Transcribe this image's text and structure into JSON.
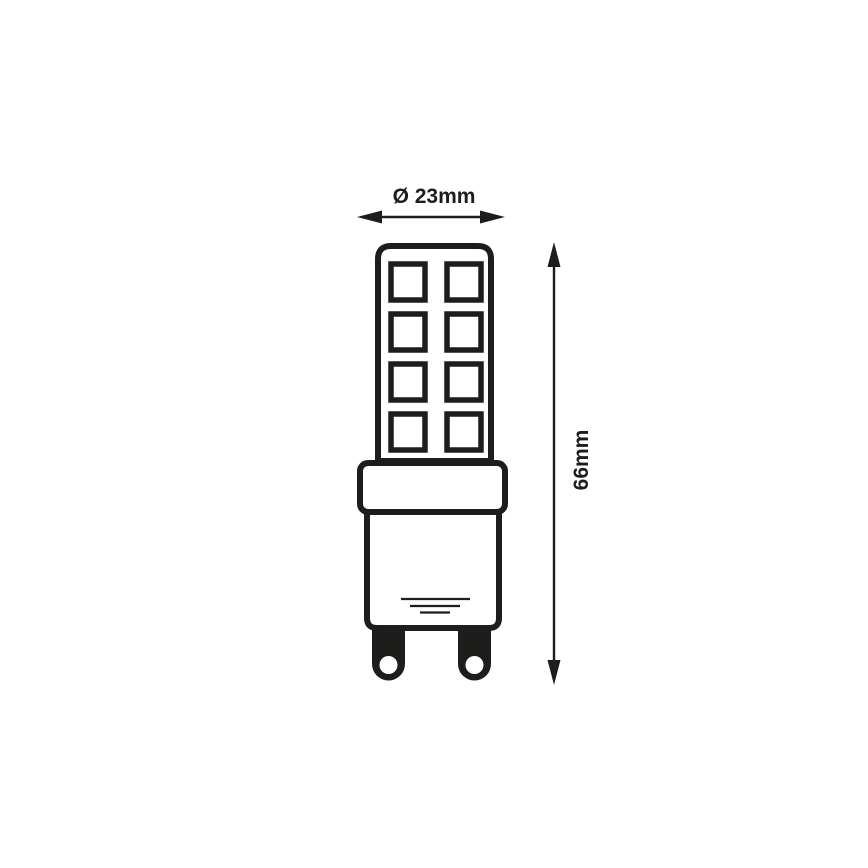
{
  "colors": {
    "background": "#ffffff",
    "ink": "#1d1d1b"
  },
  "diagram": {
    "type": "technical dimension drawing",
    "subject": "G9 LED capsule bulb, front view",
    "width_dimension": {
      "label": "Ø 23mm",
      "value_mm": 23
    },
    "height_dimension": {
      "label": "66mm",
      "value_mm": 66
    },
    "led_chips": {
      "rows": 4,
      "columns": 2,
      "count": 8
    }
  }
}
